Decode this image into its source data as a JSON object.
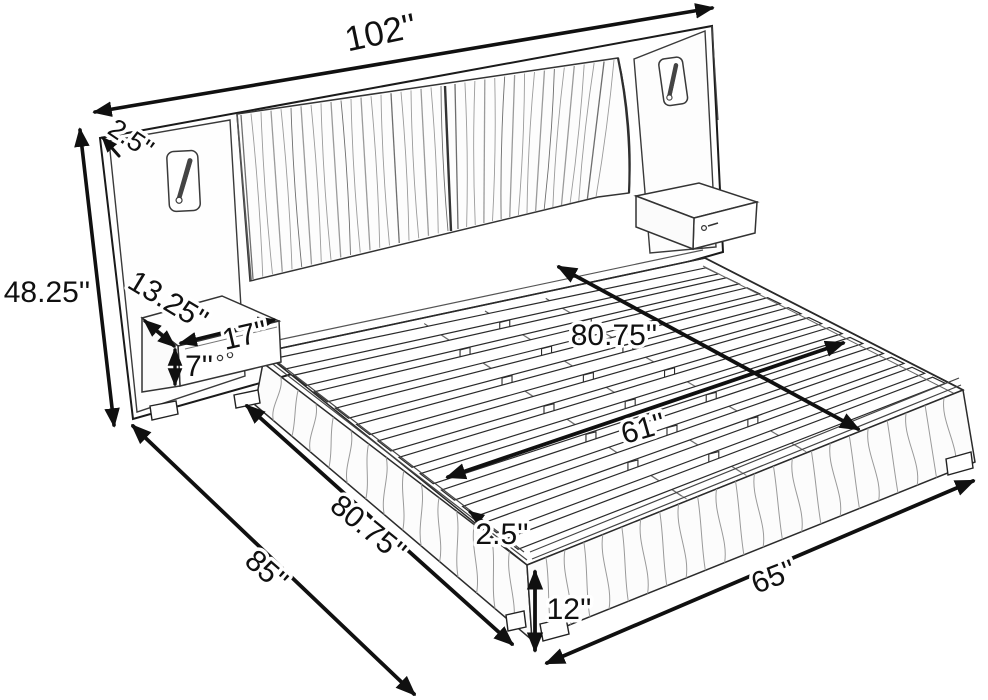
{
  "diagram": {
    "type": "product-dimension-diagram",
    "subject": "upholstered platform bed with wingback wall headboard, two attached floating nightstands, reading lamps and wood slat deck",
    "unit": "inches",
    "dimensions": {
      "headboard_width": "102''",
      "headboard_thickness": "2.5''",
      "headboard_height": "48.25''",
      "nightstand_depth": "13.25''",
      "nightstand_width": "17''",
      "nightstand_height": "7''",
      "slat_area_length": "80.75''",
      "slat_area_width": "61''",
      "base_length": "80.75''",
      "total_length": "85''",
      "side_rail_thickness": "2.5''",
      "base_height": "12''",
      "base_width": "65''"
    },
    "colors": {
      "background": "#ffffff",
      "line": "#111111",
      "soft_line": "#555555",
      "texture": "#999999"
    }
  }
}
